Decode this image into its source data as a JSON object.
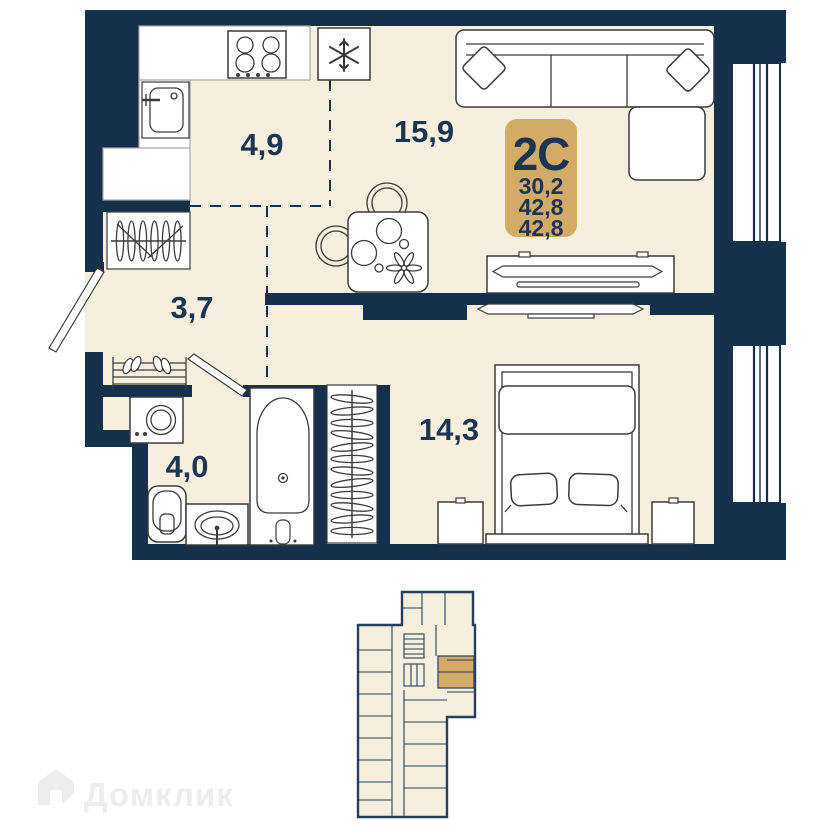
{
  "palette": {
    "wall": "#15304a",
    "floor": "#f6efde",
    "gold": "#d3ab66",
    "ink": "#1c3553",
    "fixture_stroke": "#3c3c3c",
    "watermark": "#ededed",
    "page": "#ffffff"
  },
  "unit_badge": {
    "type": "2С",
    "areas": [
      "30,2",
      "42,8",
      "42,8"
    ]
  },
  "rooms": [
    {
      "name": "kitchen",
      "area": "4,9"
    },
    {
      "name": "living-room",
      "area": "15,9"
    },
    {
      "name": "hallway",
      "area": "3,7"
    },
    {
      "name": "bathroom",
      "area": "4,0"
    },
    {
      "name": "bedroom",
      "area": "14,3"
    }
  ],
  "watermark": {
    "brand": "Домклик"
  },
  "icons": {
    "stove-icon": "4-burner cooktop",
    "fridge-icon": "snowflake",
    "kitchen-sink-icon": "sink with faucet",
    "wardrobe-icon": "rail with hangers",
    "shoe-rack-icon": "shelf with shoes",
    "door-icon": "open door leaf",
    "washing-machine-icon": "drum front",
    "toilet-icon": "toilet",
    "vanity-sink-icon": "oval basin",
    "bathtub-icon": "bathtub",
    "closet-icon": "rail with hangers",
    "sofa-icon": "corner sofa with pillows",
    "dining-table-icon": "table with chairs and plates",
    "tv-stand-icon": "media console with tv",
    "tv-icon": "wall tv",
    "bed-icon": "double bed with pillows",
    "nightstand-icon": "bedside table",
    "window-icon": "triple glazing",
    "brand-house-icon": "house logo"
  }
}
